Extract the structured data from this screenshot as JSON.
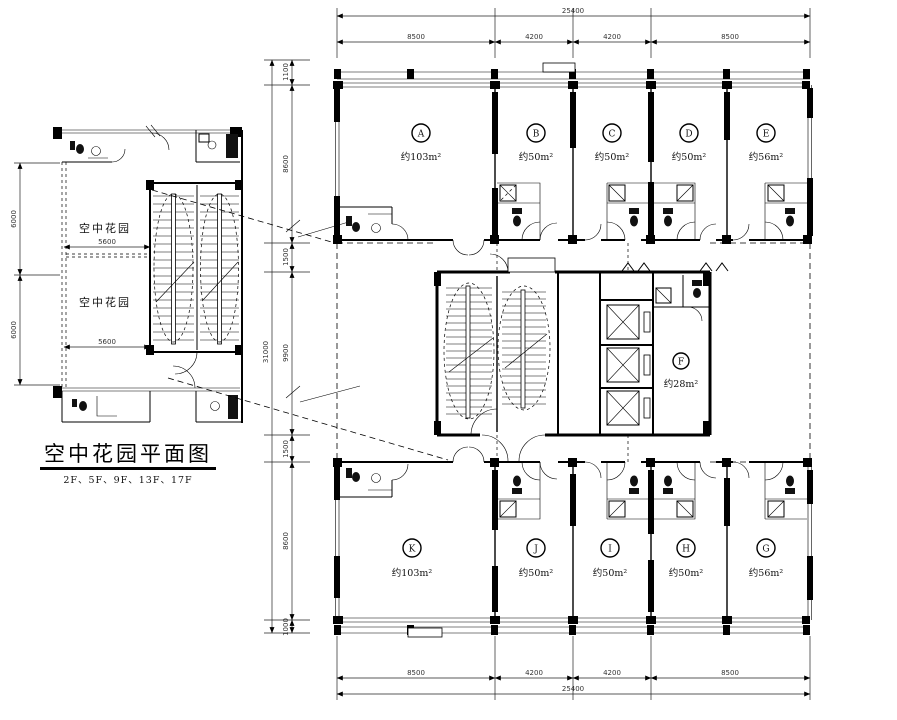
{
  "inset": {
    "title": "空中花园平面图",
    "floors": "2F、5F、9F、13F、17F",
    "garden1": "空中花园",
    "garden2": "空中花园",
    "dim_w1": "5600",
    "dim_w2": "5600",
    "dim_h1": "6000",
    "dim_h2": "6000"
  },
  "main": {
    "dims_top": {
      "total": "25400",
      "segments": [
        "8500",
        "4200",
        "4200",
        "8500"
      ]
    },
    "dims_bottom": {
      "total": "25400",
      "segments": [
        "8500",
        "4200",
        "4200",
        "8500"
      ]
    },
    "dims_left": {
      "total": "31000",
      "segments": [
        "1100",
        "8600",
        "1500",
        "9900",
        "1500",
        "8600",
        "1000"
      ]
    },
    "rooms_upper": [
      {
        "id": "A",
        "area": "约103m²"
      },
      {
        "id": "B",
        "area": "约50m²"
      },
      {
        "id": "C",
        "area": "约50m²"
      },
      {
        "id": "D",
        "area": "约50m²"
      },
      {
        "id": "E",
        "area": "约56m²"
      }
    ],
    "rooms_lower": [
      {
        "id": "K",
        "area": "约103m²"
      },
      {
        "id": "J",
        "area": "约50m²"
      },
      {
        "id": "I",
        "area": "约50m²"
      },
      {
        "id": "H",
        "area": "约50m²"
      },
      {
        "id": "G",
        "area": "约56m²"
      }
    ],
    "room_core": {
      "id": "F",
      "area": "约28m²"
    }
  }
}
